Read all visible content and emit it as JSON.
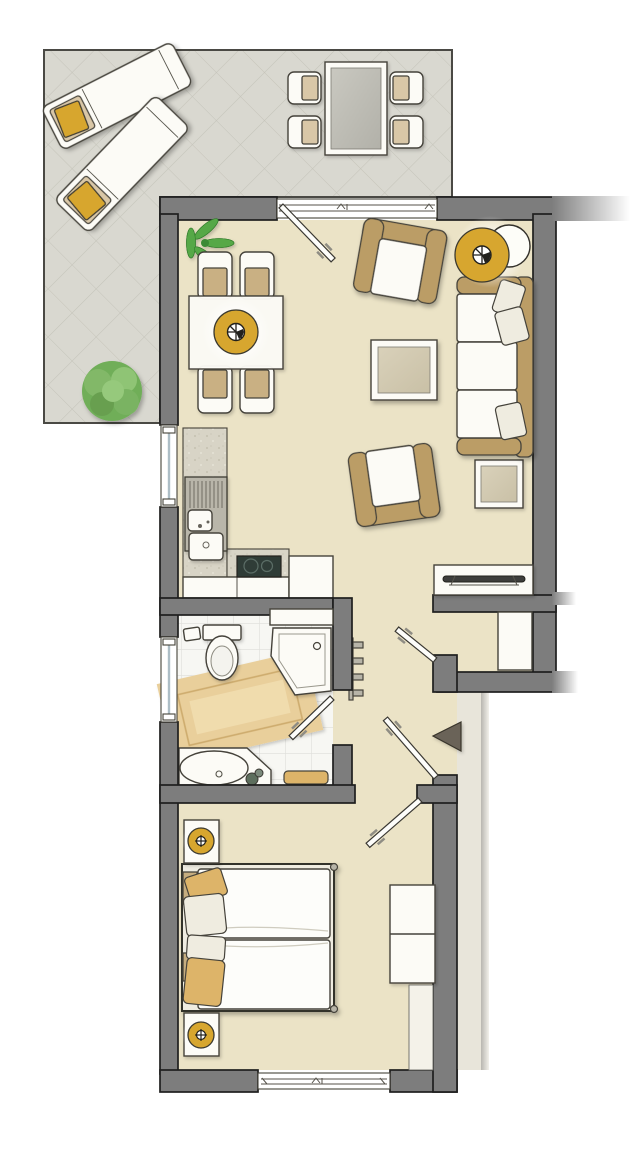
{
  "document": {
    "kind": "apartment-floor-plan",
    "orientation": "portrait",
    "visible_text": "none"
  },
  "palette": {
    "wall": "#7d7d7d",
    "ink": "#1f1f1e",
    "floor": "#ebe3c6",
    "terrace": "#d9d8d0",
    "hatch": "#c5c4ba",
    "landing": "#e8e5da",
    "white_furniture": "#fcfbf6",
    "tan": "#bb9d66",
    "gold": "#d7a62f",
    "gold_soft": "#ddb469",
    "cooktop": "#2f3c37",
    "rug": "#e9cf9b",
    "glass": "#adbec6",
    "plant": "#57a847",
    "bush": "#82b868",
    "arrow": "#6b6458"
  },
  "terrace": {
    "name": "terrace",
    "surface": "diagonal-hatch-paving",
    "furniture": [
      {
        "item": "sun-lounger",
        "count": 2,
        "cushion_color": "gold"
      },
      {
        "item": "outdoor-dining-table",
        "seats": 4
      },
      {
        "item": "shrub",
        "count": 1
      }
    ]
  },
  "rooms": [
    {
      "name": "living-dining-room",
      "furniture": [
        "potted-plant",
        "dining-table",
        "dining-chair x4",
        "pendant-lamp",
        "armchair x2",
        "coffee-table",
        "side-table",
        "sofa-3-seat",
        "sofa-cushion x3",
        "floor-lamp",
        "sideboard"
      ]
    },
    {
      "name": "open-kitchen",
      "furniture": [
        "l-shaped-counter",
        "sink-with-drainboard",
        "cooktop-2-zone",
        "base-cabinets",
        "tall-unit"
      ]
    },
    {
      "name": "bathroom",
      "furniture": [
        "toilet",
        "toilet-paper-holder",
        "corner-shower",
        "wall-shelf",
        "bath-rug",
        "vanity-with-basin",
        "bath-mat",
        "towel-radiator"
      ]
    },
    {
      "name": "hallway",
      "furniture": [
        "built-in-closet",
        "entrance-arrow"
      ]
    },
    {
      "name": "bedroom",
      "furniture": [
        "double-bed",
        "bed-pillow x4",
        "nightstand x2",
        "table-lamp x2",
        "wardrobe-2-door",
        "wall-panel"
      ]
    }
  ],
  "openings": {
    "windows": [
      {
        "location": "living-room-top",
        "type": "sliding-terrace-door"
      },
      {
        "location": "kitchen-left-wall",
        "type": "window"
      },
      {
        "location": "bathroom-left-wall",
        "type": "window"
      },
      {
        "location": "bedroom-bottom-wall",
        "type": "window"
      }
    ],
    "doors": [
      {
        "location": "terrace-to-living"
      },
      {
        "location": "hall-storage-niche"
      },
      {
        "location": "front-entrance"
      },
      {
        "location": "bathroom"
      },
      {
        "location": "bedroom"
      }
    ],
    "entrance_direction": "left"
  }
}
